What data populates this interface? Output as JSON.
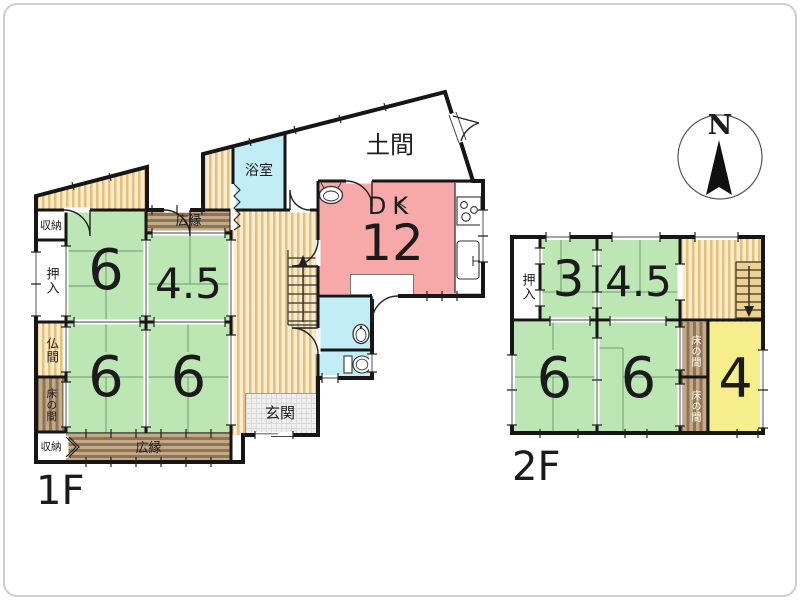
{
  "floor1": {
    "floor_label": "1F",
    "rooms": {
      "doma": "土間",
      "bathroom": "浴室",
      "dk_label": "DK",
      "dk_size": "12",
      "storage_top": "収納",
      "closet": "押入",
      "veranda_top": "広縁",
      "room6_nw": "6",
      "room45": "4.5",
      "butsuma": "仏間",
      "tokonoma": "床の間",
      "room6_sw": "6",
      "room6_sc": "6",
      "storage_bottom": "収納",
      "veranda_bottom": "広縁",
      "genkan": "玄関"
    }
  },
  "floor2": {
    "floor_label": "2F",
    "rooms": {
      "closet": "押入",
      "room3": "3",
      "room45": "4.5",
      "room6_w": "6",
      "room6_c": "6",
      "tokonoma_upper": "床の間",
      "tokonoma_lower": "床の間",
      "room4": "4"
    }
  },
  "compass": {
    "north_label": "N"
  },
  "colors": {
    "tatami_green": "#bce7b5",
    "dk_pink": "#f7a8a8",
    "water_blue": "#c3edf6",
    "room_yellow": "#f6ee8d",
    "stripe_gold_dark": "#e5c077",
    "stripe_gold_light": "#f7ecd2",
    "stripe_brown_dark": "#8f7355",
    "stripe_brown_light": "#c2a988",
    "wall_black": "#161616"
  }
}
